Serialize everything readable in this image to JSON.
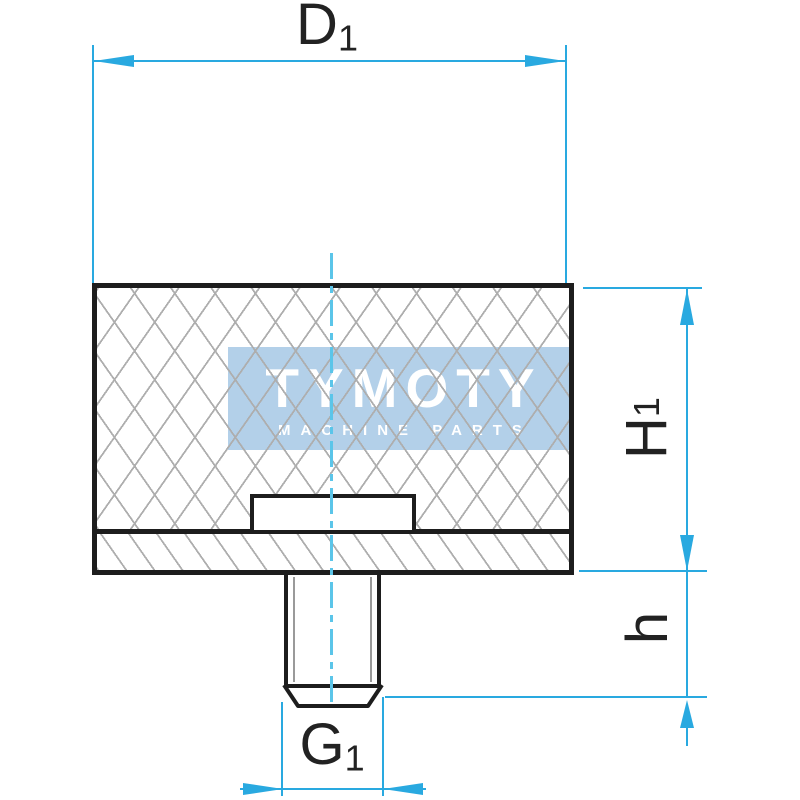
{
  "watermark": {
    "brand": "TYMOTY",
    "tagline": "MACHINE PARTS",
    "box_color": "#b3d0e9",
    "text_color": "#ffffff"
  },
  "dimensions": {
    "d1": {
      "label": "D",
      "sub": "1"
    },
    "h1": {
      "label": "H",
      "sub": "1"
    },
    "h": {
      "label": "h",
      "sub": ""
    },
    "g1": {
      "label": "G",
      "sub": "1"
    }
  },
  "colors": {
    "dimension_line": "#29a9e0",
    "centerline": "#5bc5e9",
    "outline": "#1d1d1d",
    "hatch": "#aeaeae",
    "background": "#ffffff"
  }
}
